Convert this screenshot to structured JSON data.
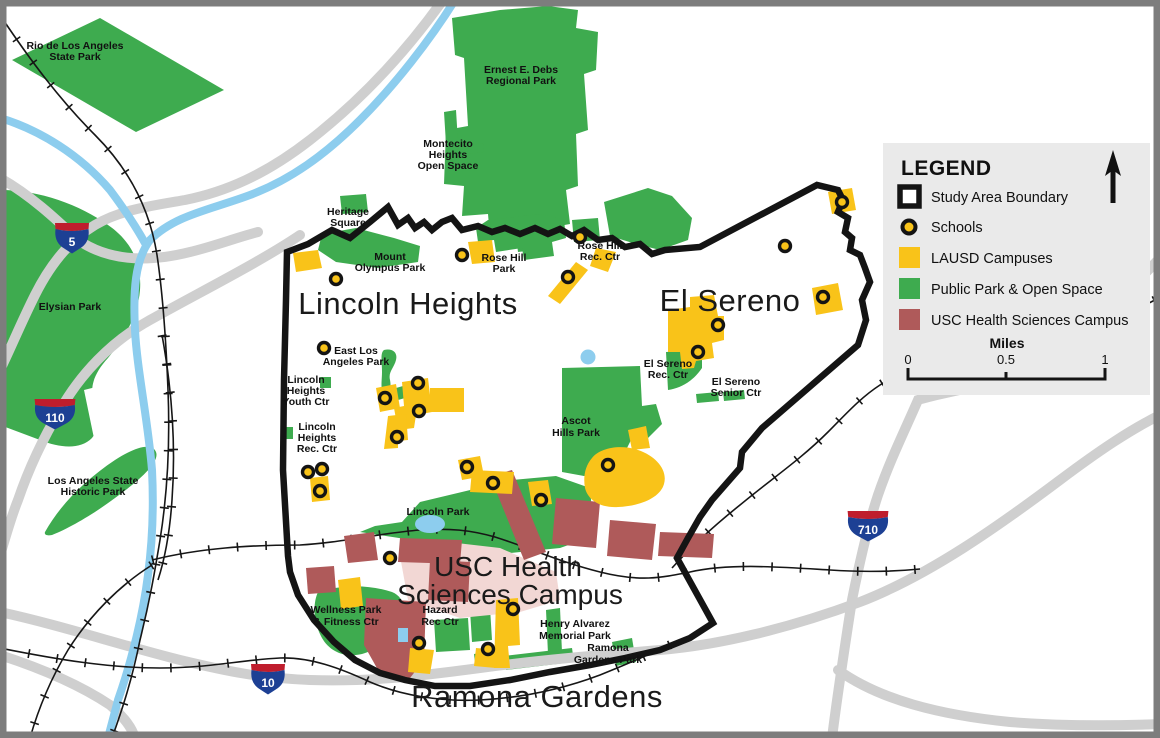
{
  "map": {
    "areas": {
      "lincoln_heights": "Lincoln Heights",
      "el_sereno": "El Sereno",
      "usc_line1": "USC Health",
      "usc_line2": "Sciences Campus",
      "ramona_gardens": "Ramona Gardens"
    },
    "parks": {
      "rio": {
        "l1": "Rio de Los Angeles",
        "l2": "State Park"
      },
      "elysian": {
        "l1": "Elysian Park"
      },
      "la_historic": {
        "l1": "Los Angeles State",
        "l2": "Historic Park"
      },
      "debs": {
        "l1": "Ernest E. Debs",
        "l2": "Regional Park"
      },
      "montecito": {
        "l1": "Montecito",
        "l2": "Heights",
        "l3": "Open Space"
      },
      "heritage": {
        "l1": "Heritage",
        "l2": "Square"
      },
      "mount_olympus": {
        "l1": "Mount",
        "l2": "Olympus Park"
      },
      "rose_hill_park": {
        "l1": "Rose Hill",
        "l2": "Park"
      },
      "rose_hill_rec": {
        "l1": "Rose Hill",
        "l2": "Rec. Ctr"
      },
      "east_la": {
        "l1": "East Los",
        "l2": "Angeles Park"
      },
      "lh_youth": {
        "l1": "Lincoln",
        "l2": "Heights",
        "l3": "Youth Ctr"
      },
      "lh_rec": {
        "l1": "Lincoln",
        "l2": "Heights",
        "l3": "Rec. Ctr"
      },
      "ascot": {
        "l1": "Ascot",
        "l2": "Hills Park"
      },
      "lincoln_park": {
        "l1": "Lincoln Park"
      },
      "el_sereno_rec": {
        "l1": "El Sereno",
        "l2": "Rec. Ctr"
      },
      "el_sereno_senior": {
        "l1": "El Sereno",
        "l2": "Senior Ctr"
      },
      "wellness": {
        "l1": "Wellness Park",
        "l2": "& Fitness Ctr"
      },
      "hazard": {
        "l1": "Hazard",
        "l2": "Rec Ctr"
      },
      "henry_alvarez": {
        "l1": "Henry Alvarez",
        "l2": "Memorial Park"
      },
      "ramona_gardens_park": {
        "l1": "Ramona",
        "l2": "Gardens Park"
      }
    },
    "highways": {
      "i5": "5",
      "i110": "110",
      "i10": "10",
      "i710": "710"
    }
  },
  "legend": {
    "title": "LEGEND",
    "items": [
      {
        "label": "Study Area Boundary"
      },
      {
        "label": "Schools"
      },
      {
        "label": "LAUSD Campuses"
      },
      {
        "label": "Public Park & Open Space"
      },
      {
        "label": "USC Health Sciences Campus"
      }
    ],
    "scale": {
      "title": "Miles",
      "t0": "0",
      "t05": "0.5",
      "t1": "1"
    }
  },
  "colors": {
    "park_green": "#3EAB4F",
    "lausd_yellow": "#F9C319",
    "usc_maroon": "#AF5A5A",
    "usc_pink": "#F2D7D4",
    "river_blue": "#8DCDEE",
    "freeway_gray": "#CFCFCF",
    "boundary_black": "#141414",
    "legend_bg": "#EAEAEA",
    "shield_blue": "#1D4094",
    "shield_red": "#BF1D2D"
  }
}
